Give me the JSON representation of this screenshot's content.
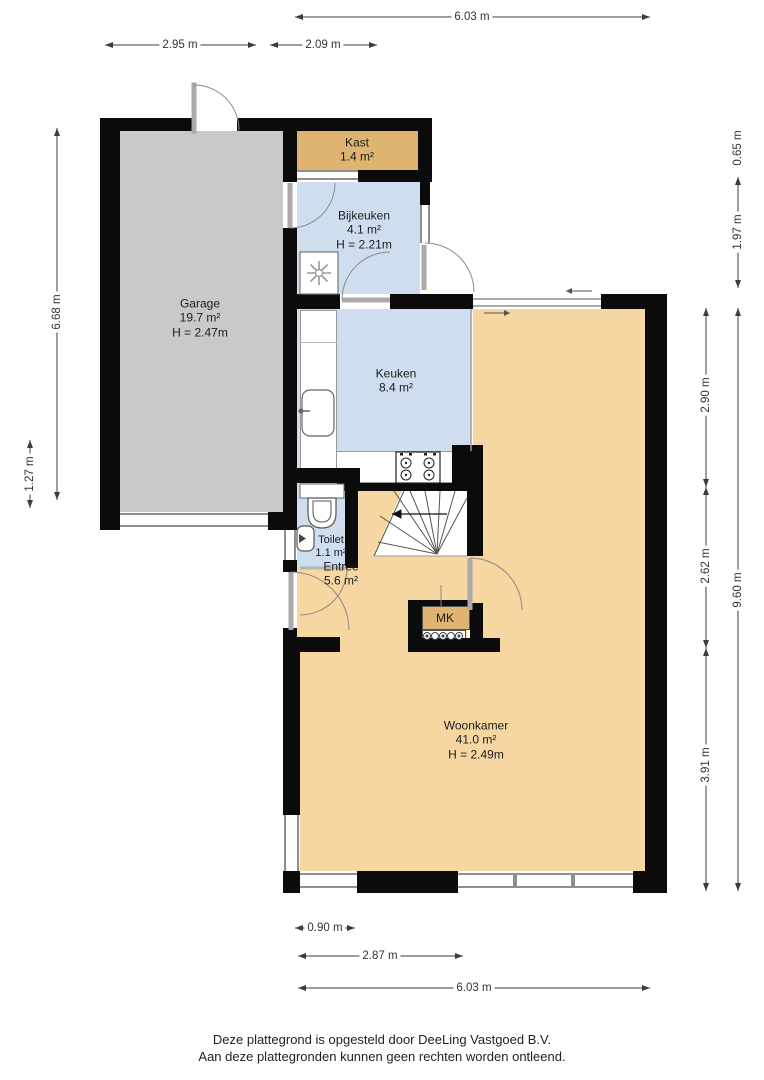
{
  "colors": {
    "wall": "#0b0b0b",
    "garage": "#c9c9c9",
    "closet": "#dfb471",
    "wet": "#cfdeee",
    "living": "#f6d6a1",
    "dim": "#3c3c3c"
  },
  "rooms": {
    "garage": {
      "name": "Garage",
      "area": "19.7 m²",
      "height": "H = 2.47m"
    },
    "kast": {
      "name": "Kast",
      "area": "1.4 m²"
    },
    "bijkeuken": {
      "name": "Bijkeuken",
      "area": "4.1 m²",
      "height": "H = 2.21m"
    },
    "keuken": {
      "name": "Keuken",
      "area": "8.4 m²"
    },
    "toilet": {
      "name": "Toilet",
      "area": "1.1 m²"
    },
    "entree": {
      "name": "Entree",
      "area": "5.6 m²"
    },
    "meterkast": {
      "name": "MK"
    },
    "woonkamer": {
      "name": "Woonkamer",
      "area": "41.0 m²",
      "height": "H = 2.49m"
    }
  },
  "dimensions": {
    "top_total": "6.03 m",
    "top_garage": "2.95 m",
    "top_bijkeuken": "2.09 m",
    "left_garage": "6.68 m",
    "left_offset": "1.27 m",
    "right_kast": "0.65 m",
    "right_bijkeuken": "1.97 m",
    "right_total": "9.60 m",
    "right_keuken": "2.90 m",
    "right_entree": "2.62 m",
    "right_woonkamer": "3.91 m",
    "bottom_door": "0.90 m",
    "bottom_left": "2.87 m",
    "bottom_total": "6.03 m"
  },
  "footer": {
    "line1": "Deze plattegrond is opgesteld door DeeLing Vastgoed B.V.",
    "line2": "Aan deze plattegronden kunnen geen rechten worden ontleend."
  }
}
